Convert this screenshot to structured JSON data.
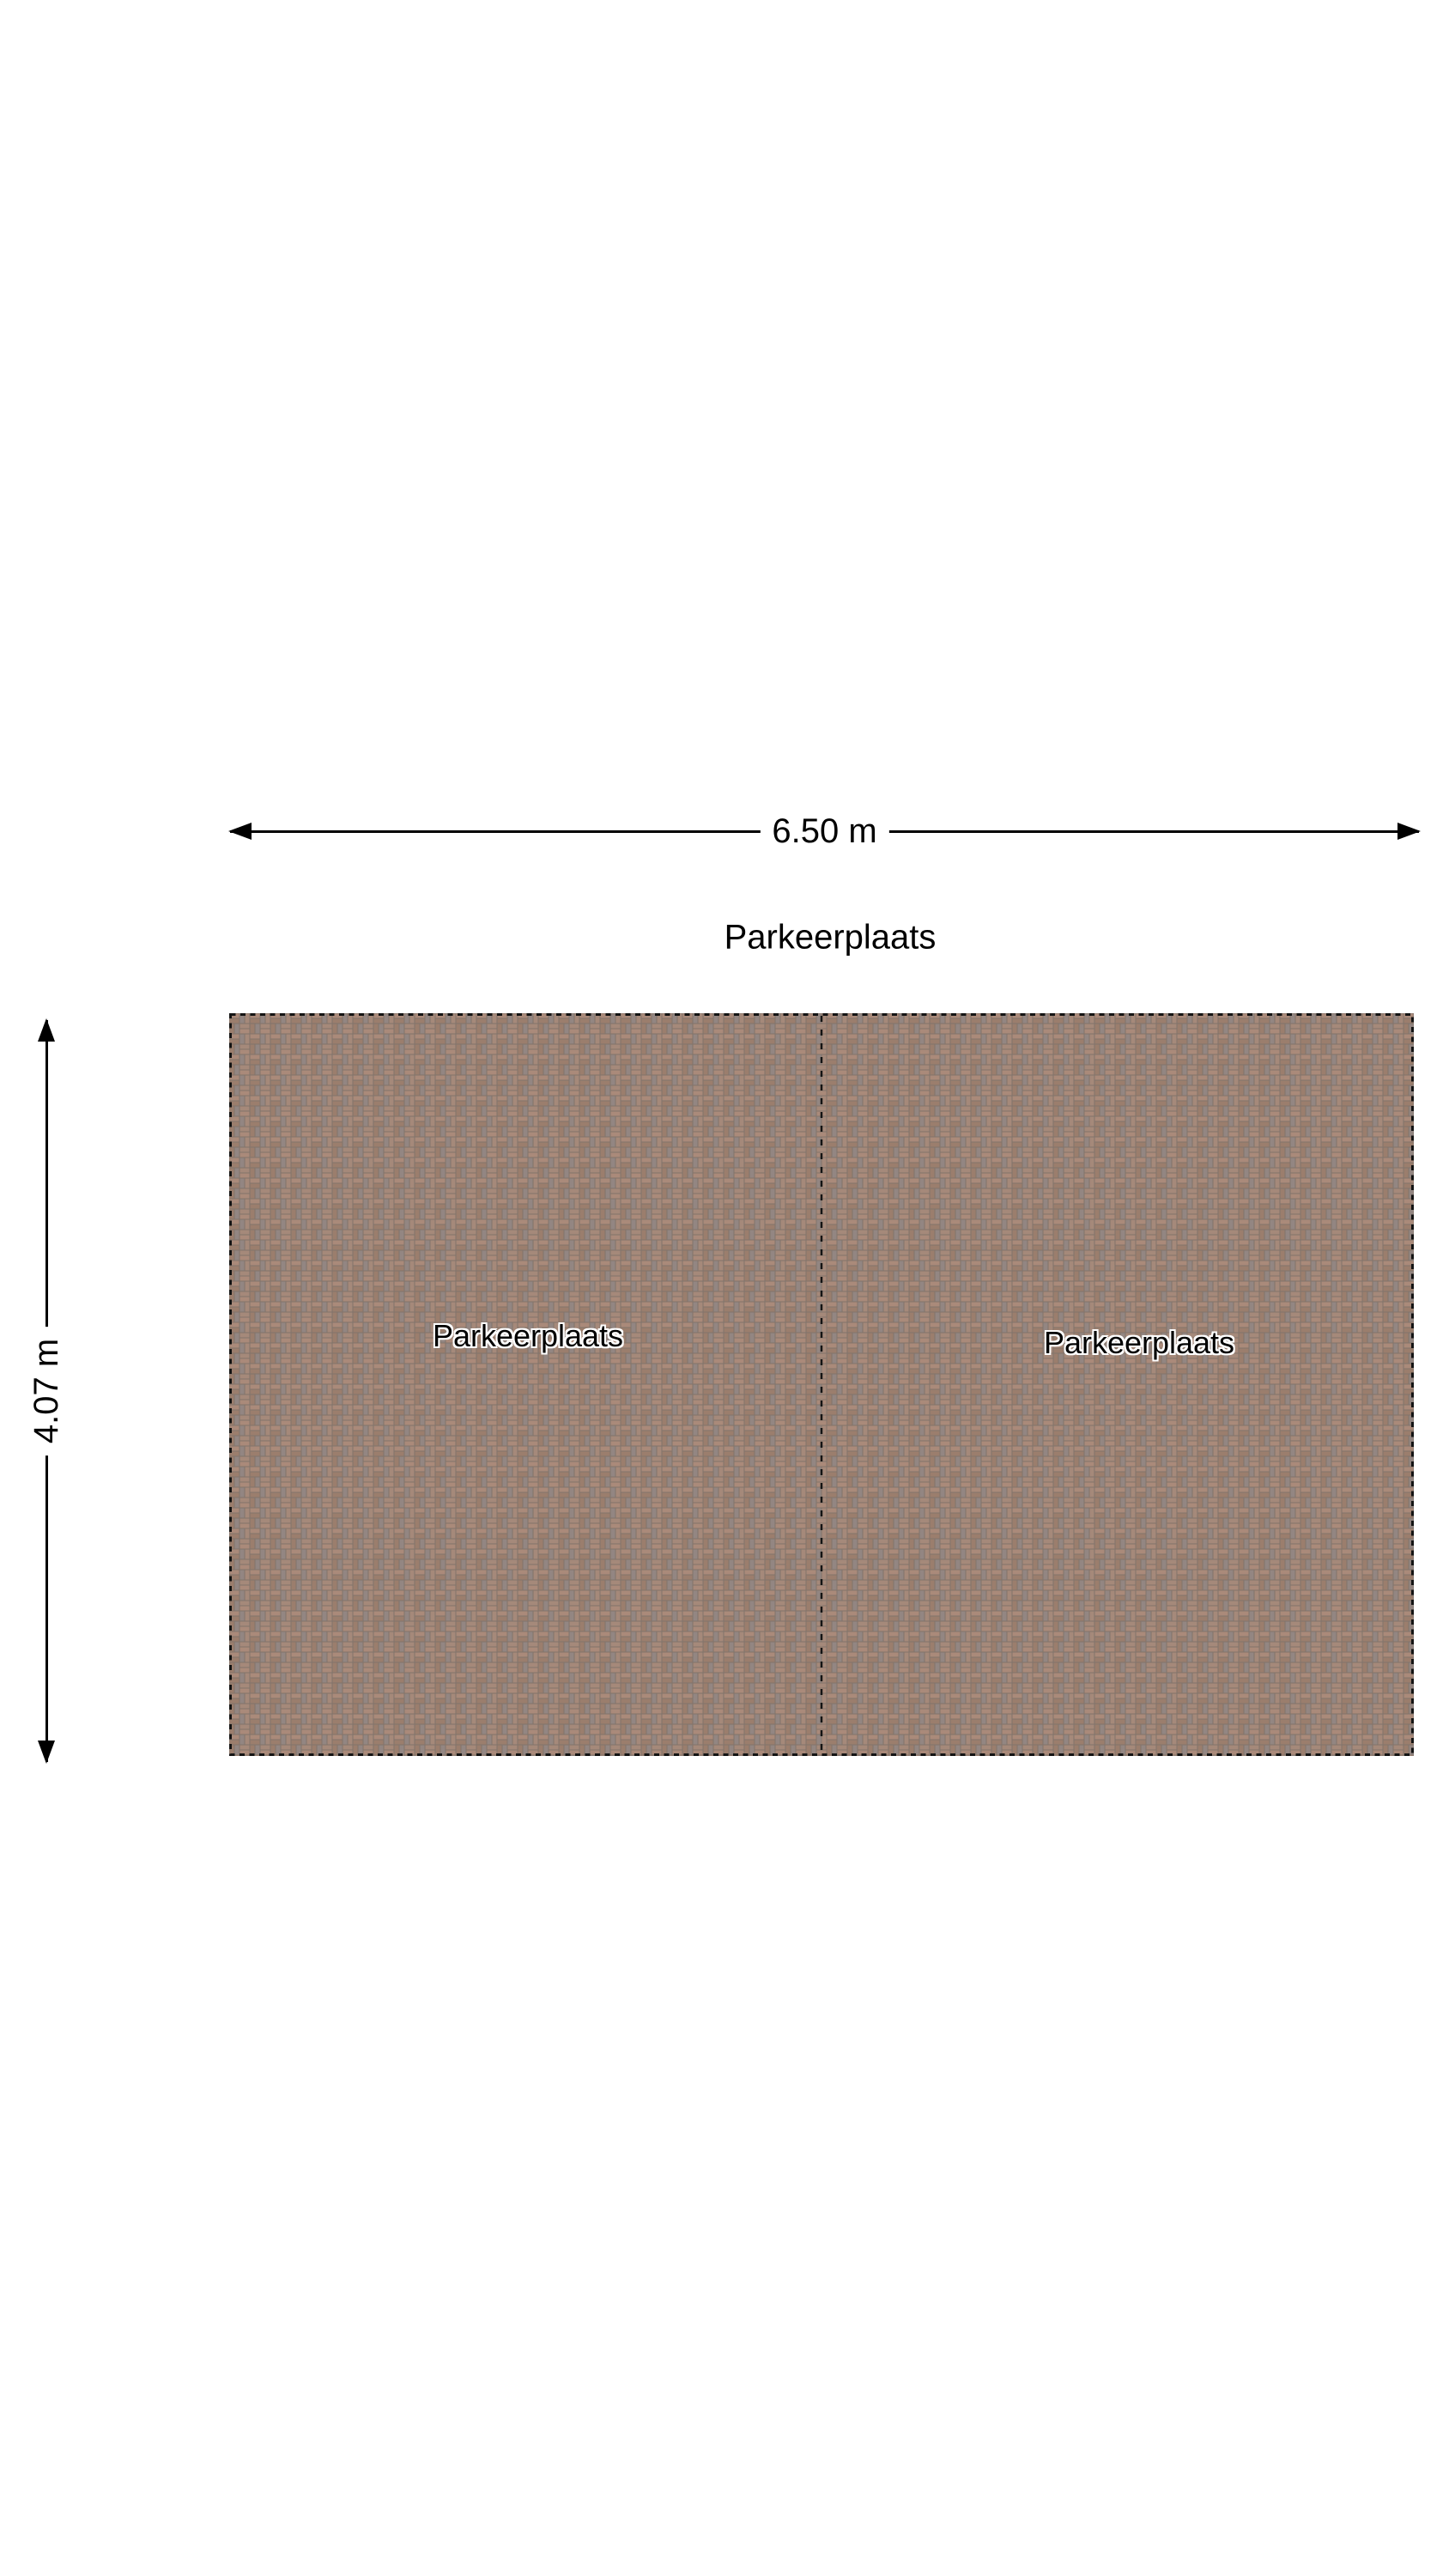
{
  "plan": {
    "title": "Parkeerplaats",
    "dimensions": {
      "width_label": "6.50 m",
      "height_label": "4.07 m"
    },
    "spaces": [
      {
        "label": "Parkeerplaats"
      },
      {
        "label": "Parkeerplaats"
      }
    ],
    "colors": {
      "background": "#ffffff",
      "text": "#000000",
      "outline": "#141414",
      "paver_pink": "#aa8a7a",
      "paver_brown": "#9b7e6d",
      "paver_gray": "#938682",
      "paver_tan": "#a5897a",
      "mortar": "#81746b"
    }
  }
}
